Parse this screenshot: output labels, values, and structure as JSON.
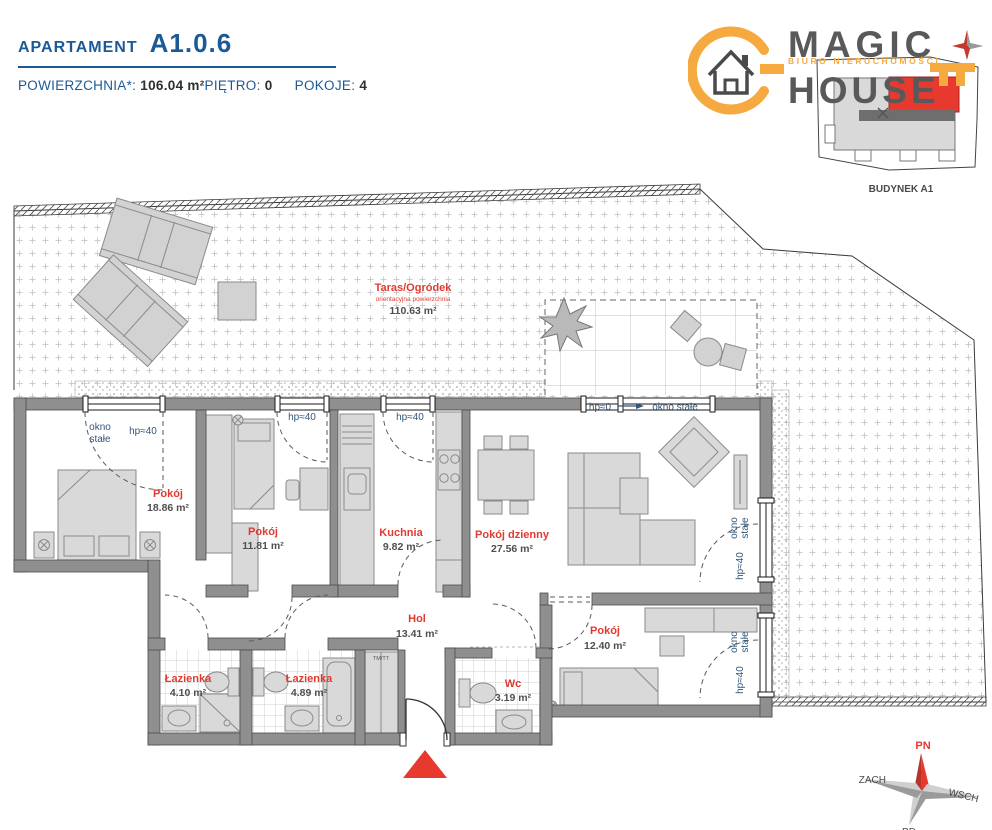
{
  "header": {
    "apartment_label": "APARTAMENT",
    "apartment_id": "A1.0.6",
    "area_label": "POWIERZCHNIA*:",
    "area_value": "106.04 m²",
    "floor_label": "PIĘTRO:",
    "floor_value": "0",
    "rooms_label": "POKOJE:",
    "rooms_value": "4"
  },
  "logo": {
    "word1": "MAGIC",
    "word2": "HOUSE",
    "tagline": "BIURO NIERUCHOMOŚCI",
    "building_label": "BUDYNEK A1",
    "accent_color": "#F5A93F",
    "text_color": "#58595B"
  },
  "plan": {
    "terrace": {
      "name": "Taras/Ogródek",
      "note": "orientacyjna powierzchnia",
      "area": "110.63 m²"
    },
    "rooms": [
      {
        "name": "Pokój",
        "area": "18.86 m²"
      },
      {
        "name": "Pokój",
        "area": "11.81 m²"
      },
      {
        "name": "Kuchnia",
        "area": "9.82 m²"
      },
      {
        "name": "Pokój dzienny",
        "area": "27.56 m²"
      },
      {
        "name": "Hol",
        "area": "13.41 m²"
      },
      {
        "name": "Pokój",
        "area": "12.40 m²"
      },
      {
        "name": "Łazienka",
        "area": "4.10 m²"
      },
      {
        "name": "Łazienka",
        "area": "4.89 m²"
      },
      {
        "name": "Wc",
        "area": "3.19 m²"
      }
    ],
    "labels": {
      "okno_line1": "okno",
      "okno_line2": "stałe",
      "okno_stale": "okno stałe",
      "hp40": "hp≈40",
      "hp0": "hp≈0",
      "closet": "TM/TT"
    }
  },
  "compass": {
    "n": "PN",
    "s": "PD",
    "e": "WSCH",
    "w": "ZACH"
  },
  "colors": {
    "header_blue": "#1C5A96",
    "red": "#E8392F",
    "label_blue": "#33567A",
    "accent": "#F5A93F"
  }
}
